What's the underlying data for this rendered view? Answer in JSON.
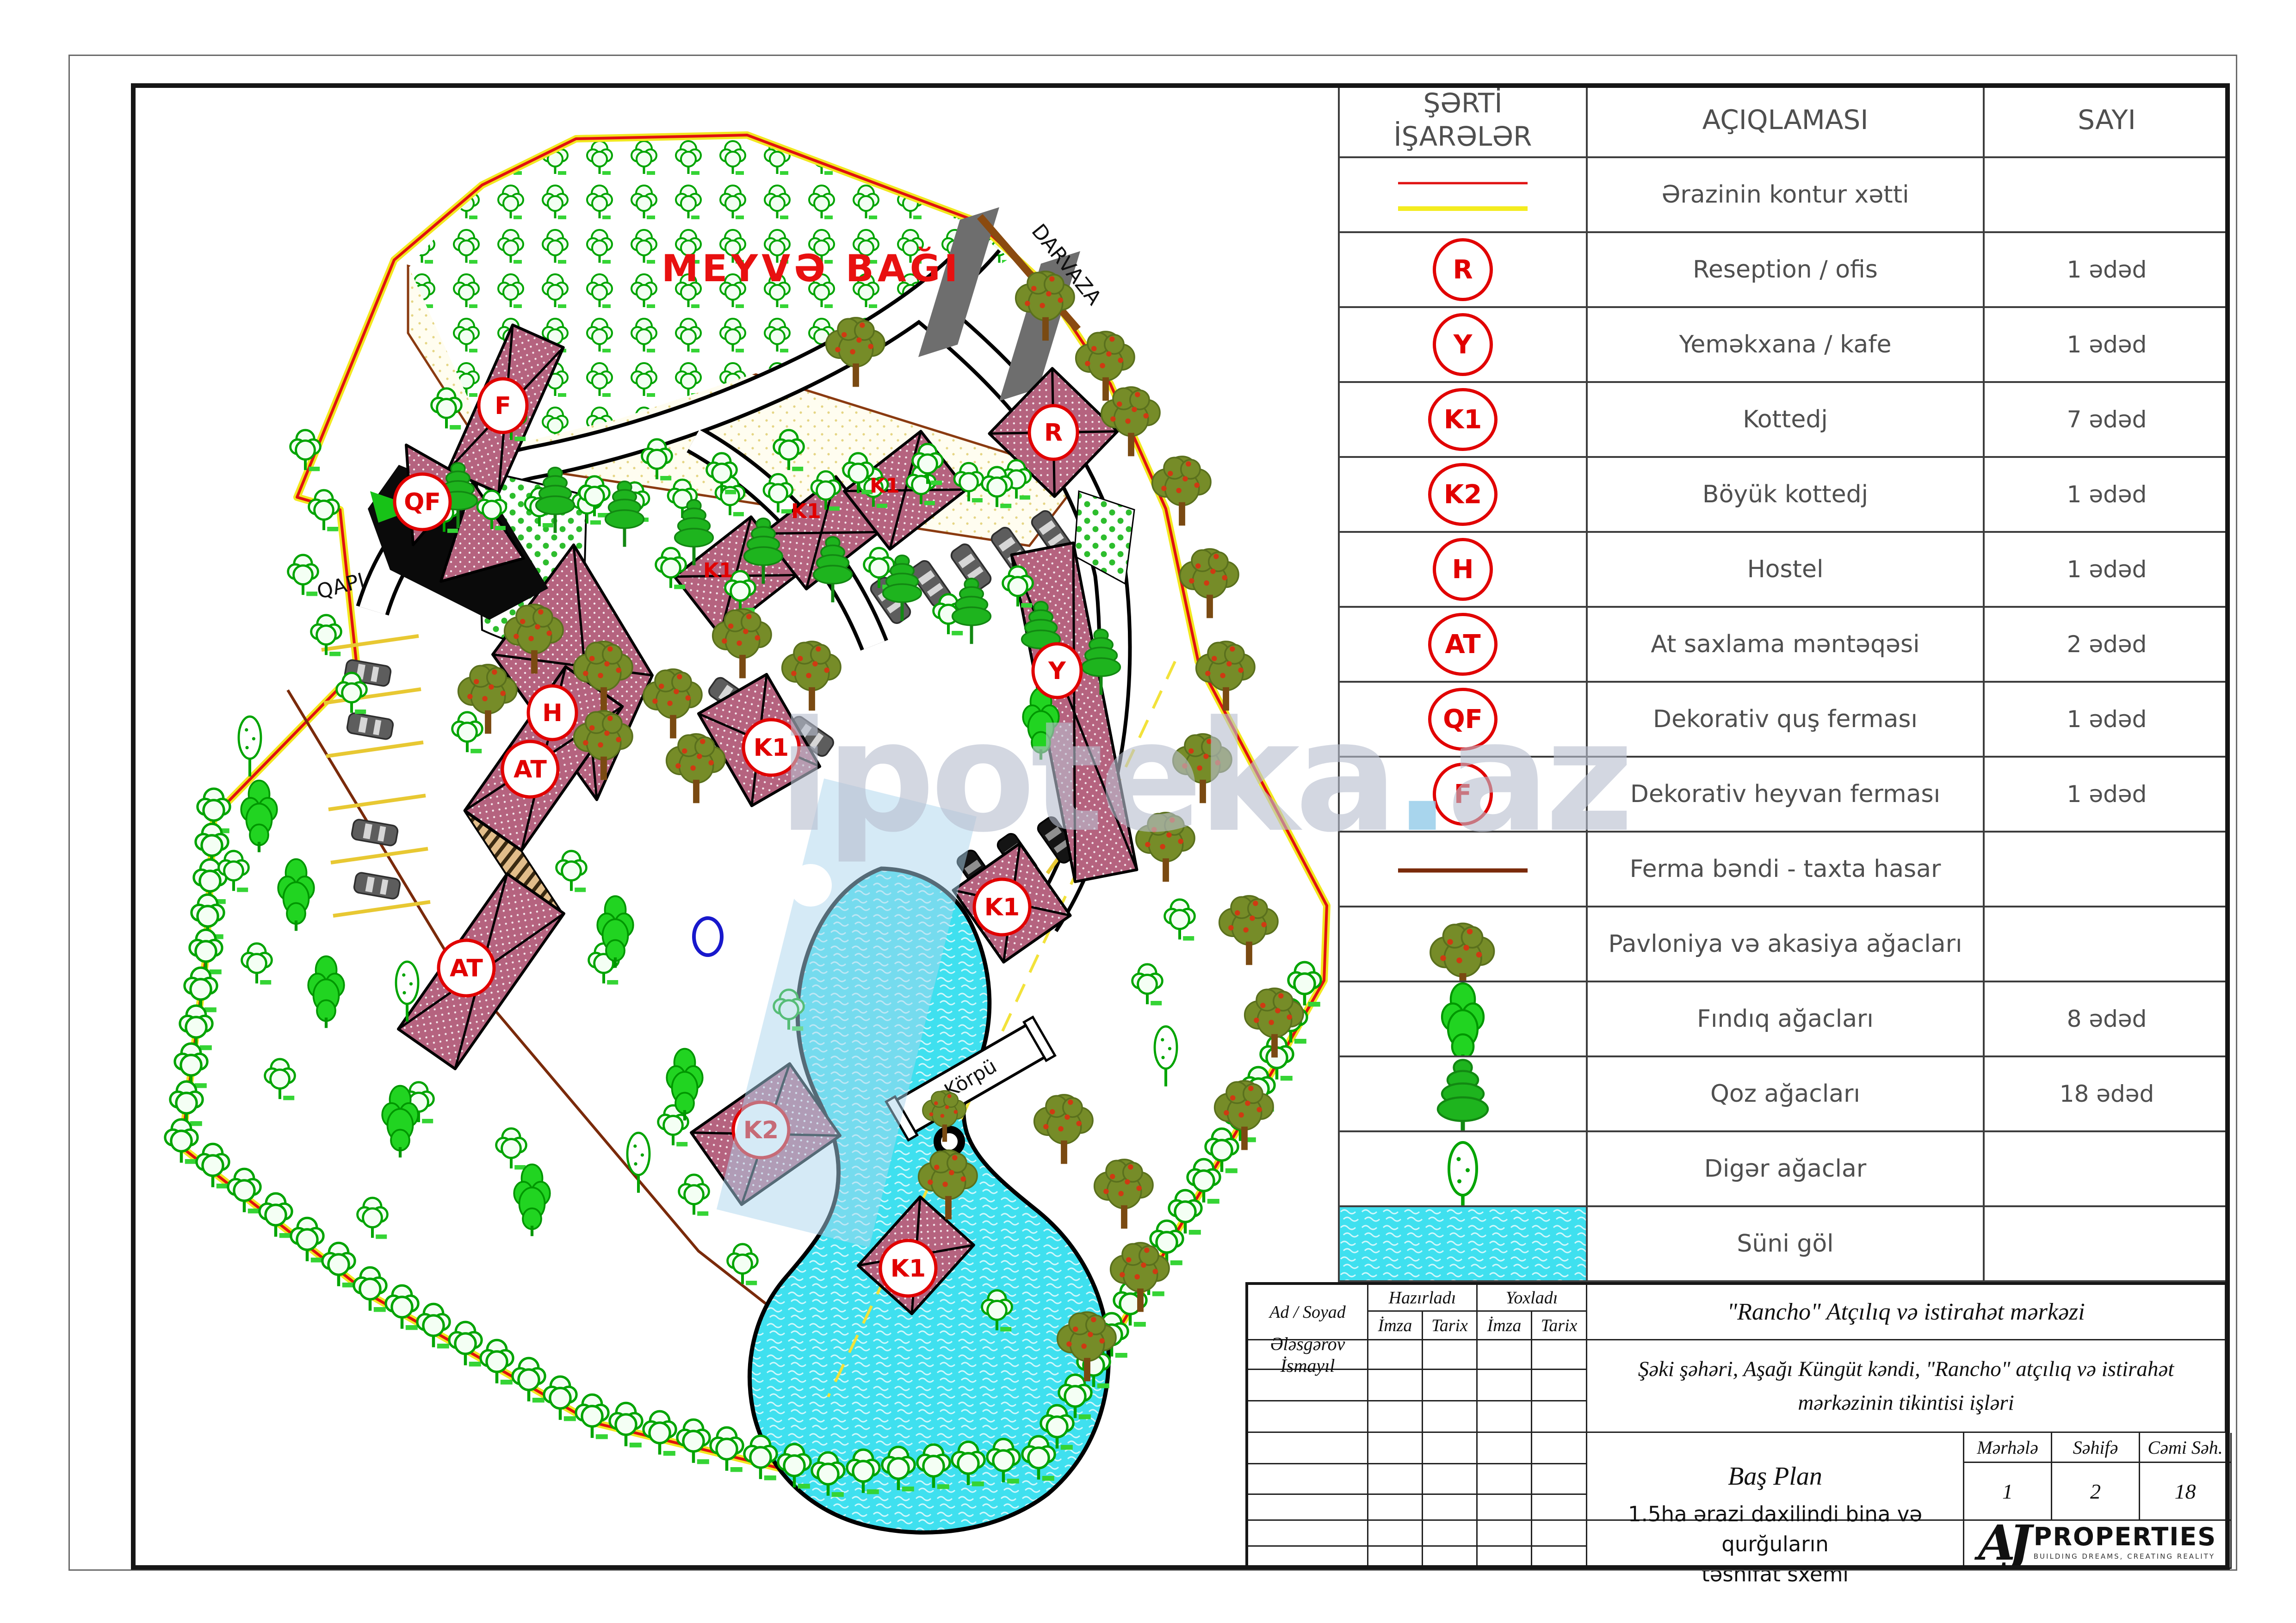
{
  "legend": {
    "header": {
      "col1_line1": "ŞƏRTİ",
      "col1_line2": "İŞARƏLƏR",
      "col2": "AÇIQLAMASI",
      "col3": "SAYI"
    },
    "rows": [
      {
        "symbol": "contour-line",
        "label": "Ərazinin kontur xətti",
        "count": ""
      },
      {
        "symbol": "R",
        "label": "Reseption / ofis",
        "count": "1 ədəd"
      },
      {
        "symbol": "Y",
        "label": "Yeməkxana / kafe",
        "count": "1 ədəd"
      },
      {
        "symbol": "K1",
        "label": "Kottedj",
        "count": "7 ədəd"
      },
      {
        "symbol": "K2",
        "label": "Böyük kottedj",
        "count": "1 ədəd"
      },
      {
        "symbol": "H",
        "label": "Hostel",
        "count": "1 ədəd"
      },
      {
        "symbol": "AT",
        "label": "At saxlama məntəqəsi",
        "count": "2 ədəd"
      },
      {
        "symbol": "QF",
        "label": "Dekorativ quş ferması",
        "count": "1 ədəd"
      },
      {
        "symbol": "F",
        "label": "Dekorativ heyvan ferması",
        "count": "1 ədəd"
      },
      {
        "symbol": "fence-line",
        "label": "Ferma bəndi - taxta hasar",
        "count": ""
      },
      {
        "symbol": "pavlonia-tree",
        "label": "Pavloniya və akasiya ağacları",
        "count": ""
      },
      {
        "symbol": "hazel-tree",
        "label": "Fındıq ağacları",
        "count": "8 ədəd"
      },
      {
        "symbol": "walnut-tree",
        "label": "Qoz ağacları",
        "count": "18 ədəd"
      },
      {
        "symbol": "other-tree",
        "label": "Digər ağaclar",
        "count": ""
      },
      {
        "symbol": "artificial-lake",
        "label": "Süni göl",
        "count": ""
      }
    ]
  },
  "plan": {
    "labels": {
      "orchard": "MEYVƏ BAĞI",
      "gate": "DARVAZA",
      "qapi": "QAPI",
      "bridge": "Körpü"
    },
    "badges": {
      "r": "R",
      "y": "Y",
      "k1": "K1",
      "k2": "K2",
      "h": "H",
      "at": "AT",
      "qf": "QF",
      "f": "F"
    }
  },
  "watermark": {
    "main": "ipoteka",
    "dot": ".",
    "suffix": "az"
  },
  "titleblock": {
    "name_header": "Ad / Soyad",
    "prepared": "Hazırladı",
    "checked": "Yoxladı",
    "sign": "İmza",
    "date": "Tarix",
    "author": "Ələsgərov İsmayıl",
    "project": "\"Rancho\" Atçılıq və istirahət mərkəzi",
    "location_line1": "Şəki şəhəri, Aşağı Küngüt kəndi, \"Rancho\" atçılıq və istirahət",
    "location_line2": "mərkəzinin tikintisi işləri",
    "sheet_title": "Baş Plan",
    "stage_label": "Mərhələ",
    "page_label": "Səhifə",
    "total_label": "Cəmi Səh.",
    "stage_value": "1",
    "page_value": "2",
    "total_value": "18",
    "note_line1": "1.5ha ərazi daxilindi bina və qurğuların",
    "note_line2": "təsnifat sxemi",
    "logo_monogram": "AJ",
    "logo_name": "PROPERTIES",
    "logo_tagline": "BUILDING DREAMS, CREATING REALITY"
  }
}
